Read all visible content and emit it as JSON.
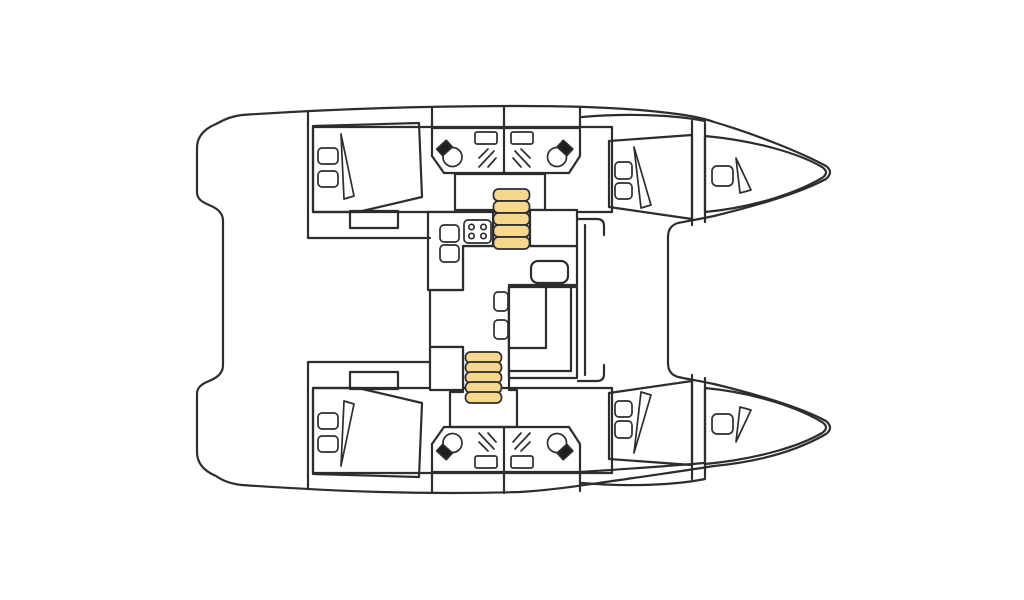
{
  "page": {
    "background": "#FFFFFF"
  },
  "diagram": {
    "kind": "catamaran-interior-deck-plan",
    "view": "top-down",
    "bow_direction": "right",
    "colors": {
      "outline": "#2D2D2D",
      "cabin_bed": "#6BA9B7",
      "hull_floor": "#A9D8E8",
      "bathroom": "#C7E09E",
      "saloon_floor": "#F7D78D",
      "bow_berth": "#BCCFD3",
      "fixture_white": "#FFFFFF",
      "toilet_tank": "#1F1F1F"
    },
    "counts": {
      "double_cabins": 4,
      "bathrooms": 4,
      "bow_berths": 2,
      "stove_burners": 4,
      "galley_sinks": 2,
      "stair_flights": 2,
      "steps_per_flight": 5
    },
    "areas": {
      "hull_port": "Port hull",
      "hull_starboard": "Starboard hull",
      "port_aft_cabin": "Port aft double cabin",
      "port_aft_head": "Port aft bathroom",
      "port_fwd_head": "Port forward bathroom",
      "port_fwd_cabin": "Port forward double cabin",
      "port_bow_berth": "Port bow berth",
      "stbd_aft_cabin": "Starboard aft double cabin",
      "stbd_aft_head": "Starboard aft bathroom",
      "stbd_fwd_head": "Starboard forward bathroom",
      "stbd_fwd_cabin": "Starboard forward double cabin",
      "stbd_bow_berth": "Starboard bow berth",
      "saloon": "Saloon",
      "galley": "Galley counter",
      "stove": "Two-by-two burner stove",
      "sinks": "Galley sinks",
      "dinette_table": "Dinette table",
      "dinette_seats": "Dinette seats",
      "nav_seat": "Saloon seat",
      "stairs_port": "Companionway steps to port hull",
      "stairs_stbd": "Companionway steps to starboard hull",
      "foredeck": "Foredeck between hulls"
    }
  }
}
